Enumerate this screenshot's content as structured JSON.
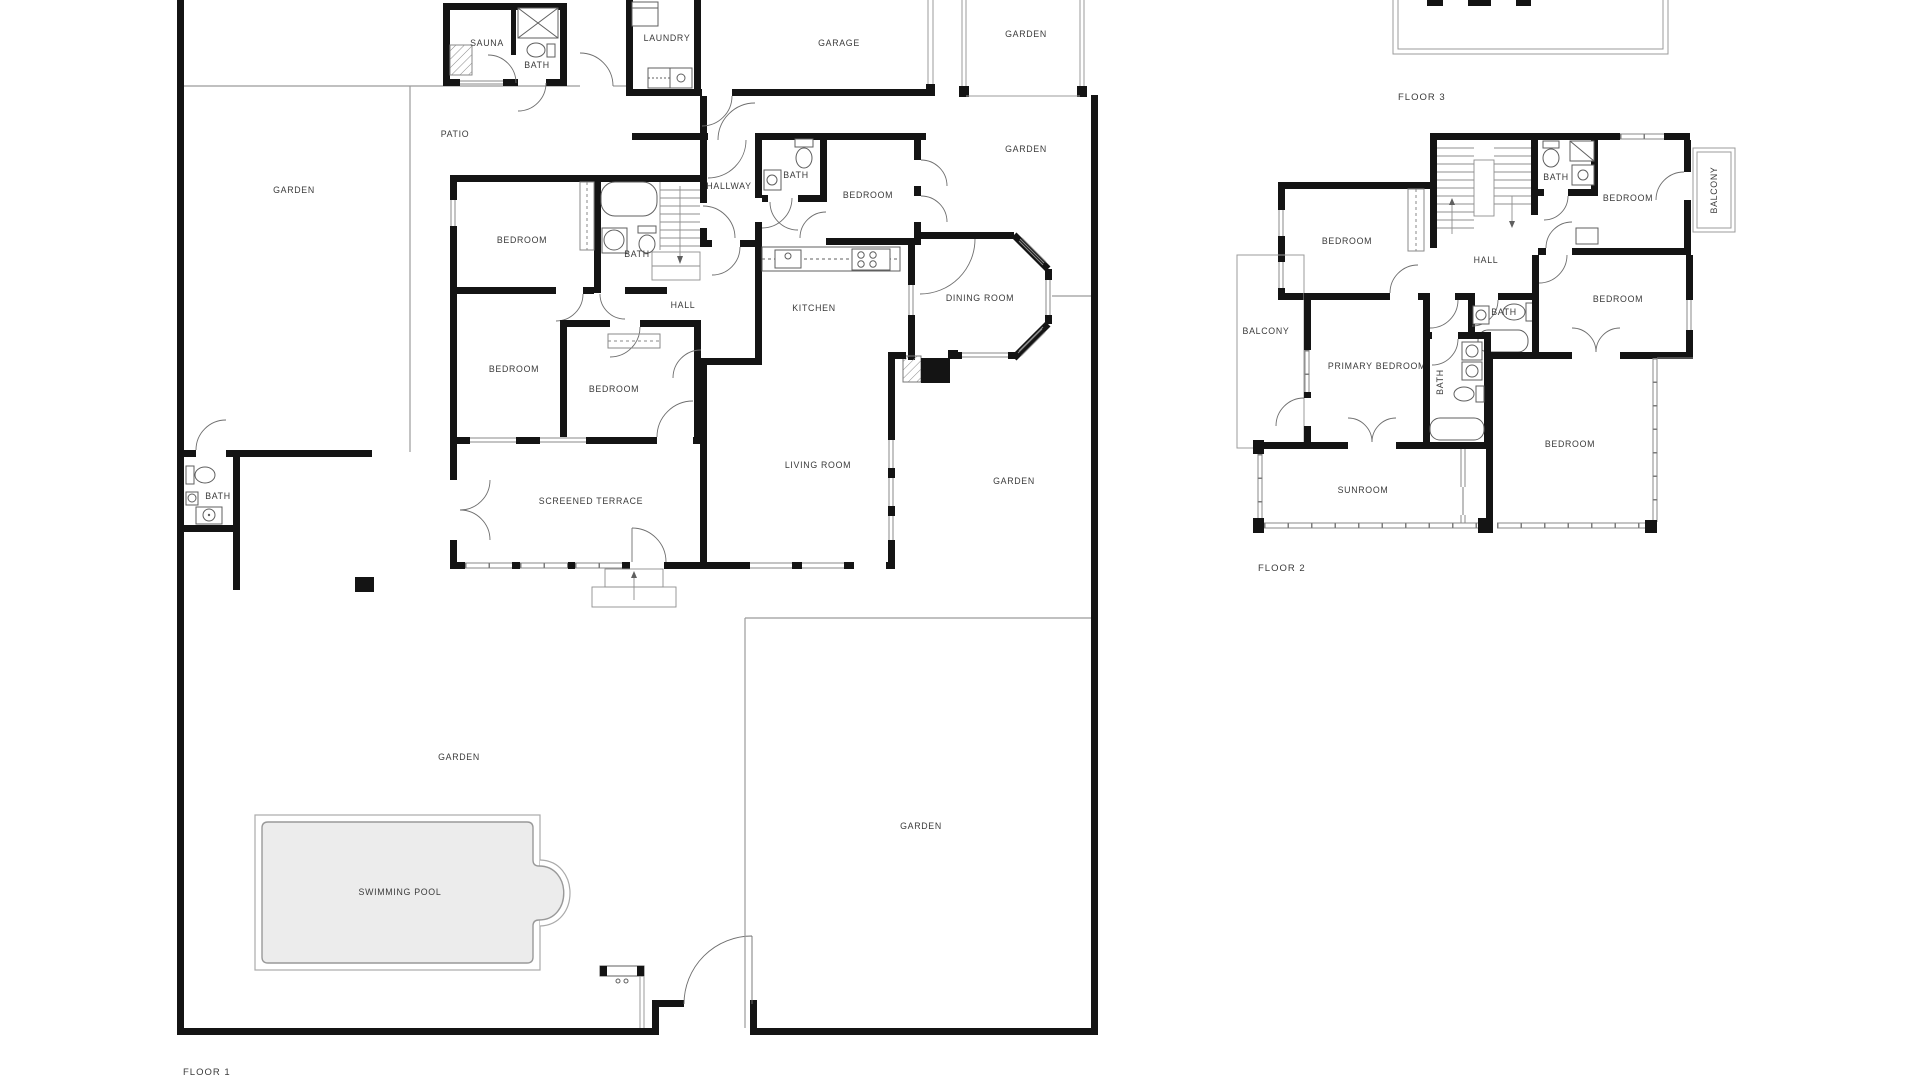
{
  "colors": {
    "wall": "#141414",
    "thin_line": "#9b9b9b",
    "fixture_line": "#5f5f5f",
    "pool_fill": "#ececec",
    "label_text": "#3a3a3a",
    "background": "#ffffff"
  },
  "floor1": {
    "name_label": "FLOOR 1",
    "rooms": {
      "sauna": "SAUNA",
      "sauna_bath": "BATH",
      "laundry": "LAUNDRY",
      "garage": "GARAGE",
      "garden_top_right": "GARDEN",
      "garden_right_strip": "GARDEN",
      "patio": "PATIO",
      "garden_left": "GARDEN",
      "hallway": "HALLWAY",
      "bath_top": "BATH",
      "bedroom_ne": "BEDROOM",
      "bedroom_nw": "BEDROOM",
      "bath_west": "BATH",
      "hall": "HALL",
      "kitchen": "KITCHEN",
      "dining_room": "DINING ROOM",
      "bedroom_w1": "BEDROOM",
      "bedroom_w2": "BEDROOM",
      "screened_terrace": "SCREENED TERRACE",
      "living_room": "LIVING ROOM",
      "garden_mid_right": "GARDEN",
      "bath_garden": "BATH",
      "garden_center": "GARDEN",
      "swimming_pool": "SWIMMING POOL",
      "garden_bottom_right": "GARDEN"
    }
  },
  "floor2": {
    "name_label": "FLOOR 2",
    "rooms": {
      "bedroom_nw": "BEDROOM",
      "bath_top": "BATH",
      "bedroom_ne": "BEDROOM",
      "balcony_right": "BALCONY",
      "hall": "HALL",
      "bedroom_e": "BEDROOM",
      "balcony_left": "BALCONY",
      "primary_bedroom": "PRIMARY BEDROOM",
      "bath_mid": "BATH",
      "bath_ensuite": "BATH",
      "bedroom_se": "BEDROOM",
      "sunroom": "SUNROOM"
    }
  },
  "floor3": {
    "name_label": "FLOOR 3"
  }
}
